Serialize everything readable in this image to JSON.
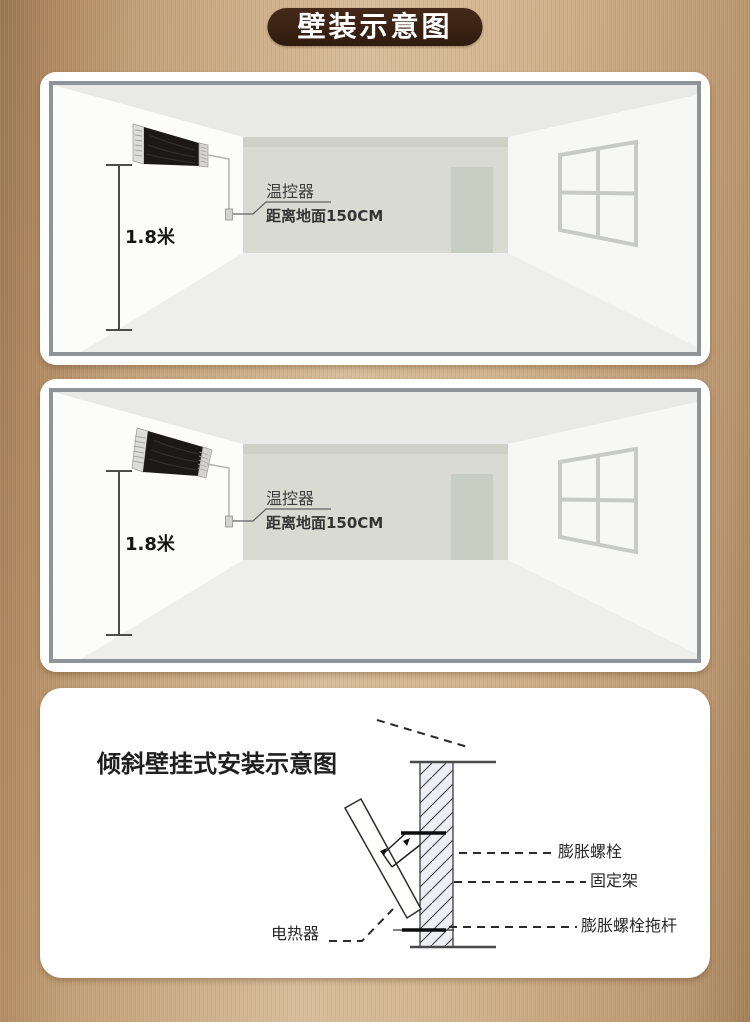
{
  "banner": {
    "label": "壁装示意图"
  },
  "rooms": [
    {
      "heater_style": "horizontal-flat-mount",
      "height_label": "1.8米",
      "thermostat_label": "温控器",
      "distance_label": "距离地面150CM"
    },
    {
      "heater_style": "tilted-mount",
      "height_label": "1.8米",
      "thermostat_label": "温控器",
      "distance_label": "距离地面150CM"
    }
  ],
  "tech": {
    "title": "倾斜壁挂式安装示意图",
    "labels": {
      "expansion_bolt": "膨胀螺栓",
      "bracket": "固定架",
      "bolt_rod": "膨胀螺栓拖杆",
      "heater": "电热器"
    }
  },
  "colors": {
    "background_bronze": "#c8a77f",
    "banner_bg": "#3a2213",
    "banner_text": "#ffffff",
    "panel_frame_border": "#8f9498",
    "heater_body": "#1c1815",
    "back_wall": "#d9dbd3",
    "door": "#c8cdc2",
    "ceiling": "#e9e9e7"
  }
}
